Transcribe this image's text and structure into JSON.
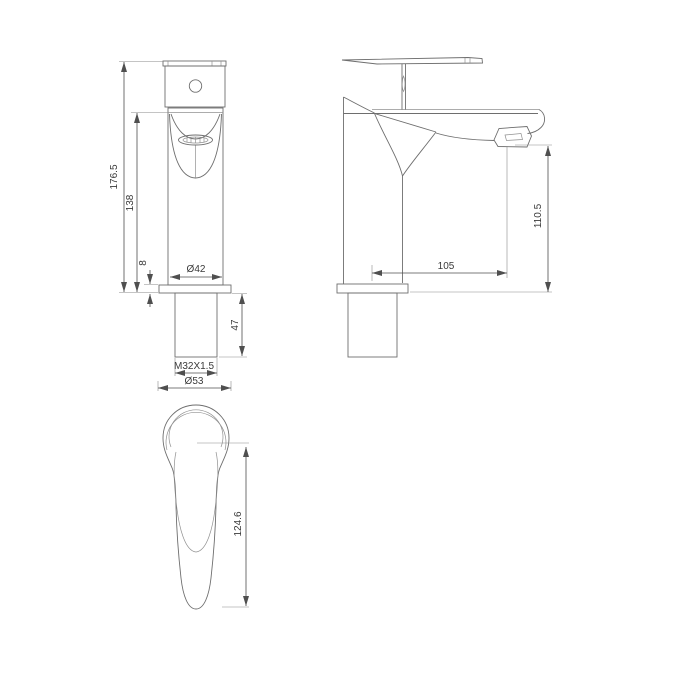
{
  "page": {
    "background": "#ffffff"
  },
  "drawing": {
    "type": "faucet-technical-drawing",
    "front_view": {
      "overall_height": "176.5",
      "upper_body_height": "138",
      "flange_thickness": "8",
      "body_diameter": "Ø42",
      "shank_length": "47",
      "thread_spec": "M32X1.5",
      "flange_diameter": "Ø53"
    },
    "side_view": {
      "spout_reach": "105",
      "outlet_height": "110.5"
    },
    "handle_top_view": {
      "handle_length": "124.6"
    },
    "colors": {
      "line": "#6e6e6e",
      "dimension_line": "#4f4f4f",
      "text": "#3a3a3a",
      "background": "#ffffff"
    }
  }
}
